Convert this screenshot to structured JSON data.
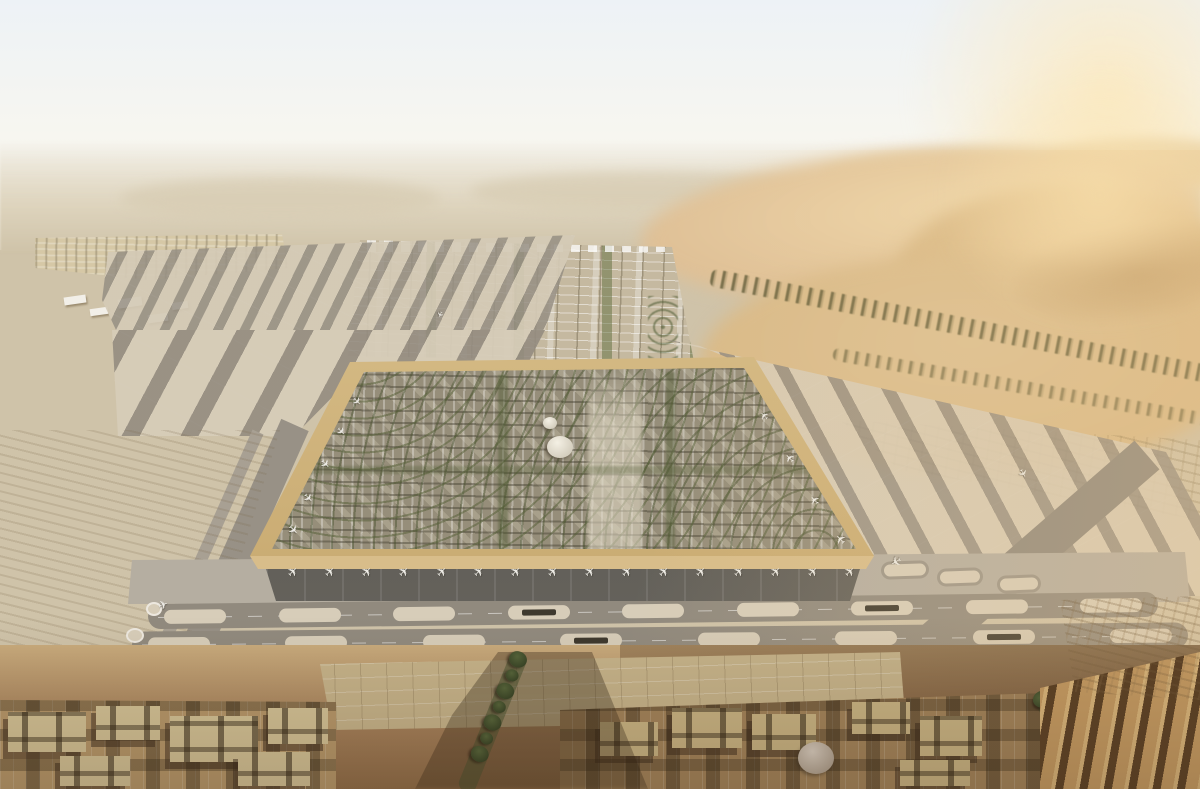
{
  "meta": {
    "title": "Aerial desert airport masterplan rendering",
    "type": "architectural-aerial-render",
    "setting": "hazy desert with golden dunes, vast runway fields, a raised square terminal-city platform and traditional low-rise blocks in the foreground"
  },
  "icons": {
    "plane": "✈"
  },
  "scene": {
    "terminal": {
      "gate_aircraft_count": 16,
      "west_aircraft_count": 5,
      "east_aircraft_count": 4,
      "dome_count": 2
    },
    "runways": {
      "runway1_island_count": 9,
      "runway2_island_count": 8,
      "circle_pad_count": 2
    },
    "foreground": {
      "boulevard_tree_count": 7,
      "right_tree_count": 6
    }
  },
  "palette": {
    "sky1": "#edf2f6",
    "sky2": "#f7f6f0",
    "haze": "#e9e2d2",
    "fardesert": "#ddd3bc",
    "hill": "#d8cdb4",
    "dune1": "#eed7ab",
    "dune2": "#dfc096",
    "dune3": "#d9ba88",
    "duneShadow": "#b58f5d",
    "glow": "#f7e3b6",
    "sand": "#cfc3a9",
    "sandWarm": "#d6c8a6",
    "taxi": "#989186",
    "runway": "#918a7e",
    "island": "#d7cdb9",
    "apron": "#b5aea1",
    "rim": "#d8bd8a",
    "rimDark": "#c09f63",
    "recess": "#56544e",
    "cityBase": "#968e7a",
    "plaza": "#d9d0bb",
    "green": "#5a6638",
    "greenDark": "#3f4a2a",
    "fgBase": "#b6976a",
    "fgBaseR": "#a2835a",
    "fgRoof": "#d3c296",
    "fgRoofR": "#c8b383",
    "fgGap": "#5e4729",
    "bar": "#c49a62",
    "barGap": "#5d4226",
    "white": "#f2efe8",
    "planeC": "#eceae4"
  }
}
